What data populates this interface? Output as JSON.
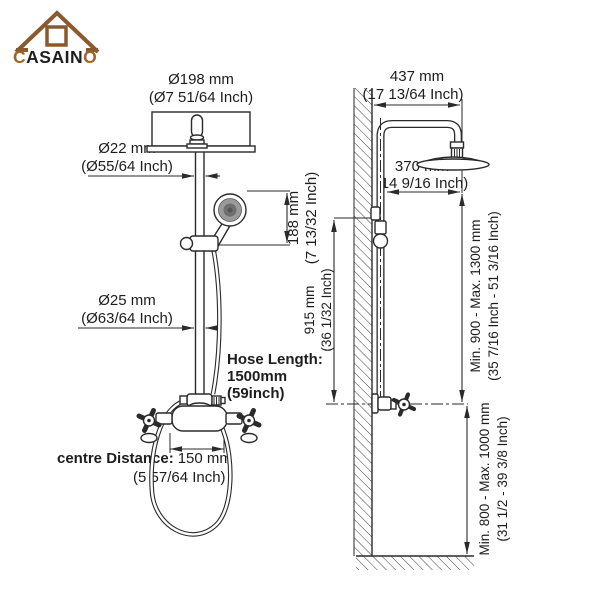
{
  "logo": {
    "prefix": "C",
    "middle": "ASAIN",
    "suffix": "O"
  },
  "front_view": {
    "head_diameter": {
      "mm": "Ø198 mm",
      "inch": "(Ø7 51/64 Inch)"
    },
    "upper_pipe_diameter": {
      "mm": "Ø22 mm",
      "inch": "(Ø55/64 Inch)"
    },
    "handheld_offset": {
      "mm": "188 mm",
      "inch": "(7 13/32 Inch)"
    },
    "lower_pipe_diameter": {
      "mm": "Ø25 mm",
      "inch": "(Ø63/64 Inch)"
    },
    "hose_length": {
      "label": "Hose Length:",
      "mm": "1500mm",
      "inch": "(59inch)"
    },
    "centre_distance": {
      "label": "centre Distance:",
      "mm": "150 mm",
      "inch": "(5 57/64 Inch)"
    }
  },
  "side_view": {
    "arm_reach": {
      "mm": "437 mm",
      "inch": "(17 13/64 Inch)"
    },
    "head_wall_offset": {
      "mm": "370 mm",
      "inch": "(14 9/16 Inch)"
    },
    "slide_bar_height": {
      "mm": "915 mm",
      "inch": "(36 1/32 Inch)"
    },
    "head_height_range": {
      "mm": "Min. 900 - Max. 1300 mm",
      "inch": "(35 7/16 Inch - 51 3/16 Inch)"
    },
    "valve_height_range": {
      "mm": "Min. 800 - Max. 1000 mm",
      "inch": "(31 1/2 - 39 3/8 Inch)"
    }
  },
  "colors": {
    "line": "#2a2a2a",
    "logo_brown": "#8a5a2e",
    "logo_letters": "#9e6527",
    "logo_dark": "#1d1d1d",
    "handheld_face": "#9a9a9a"
  }
}
